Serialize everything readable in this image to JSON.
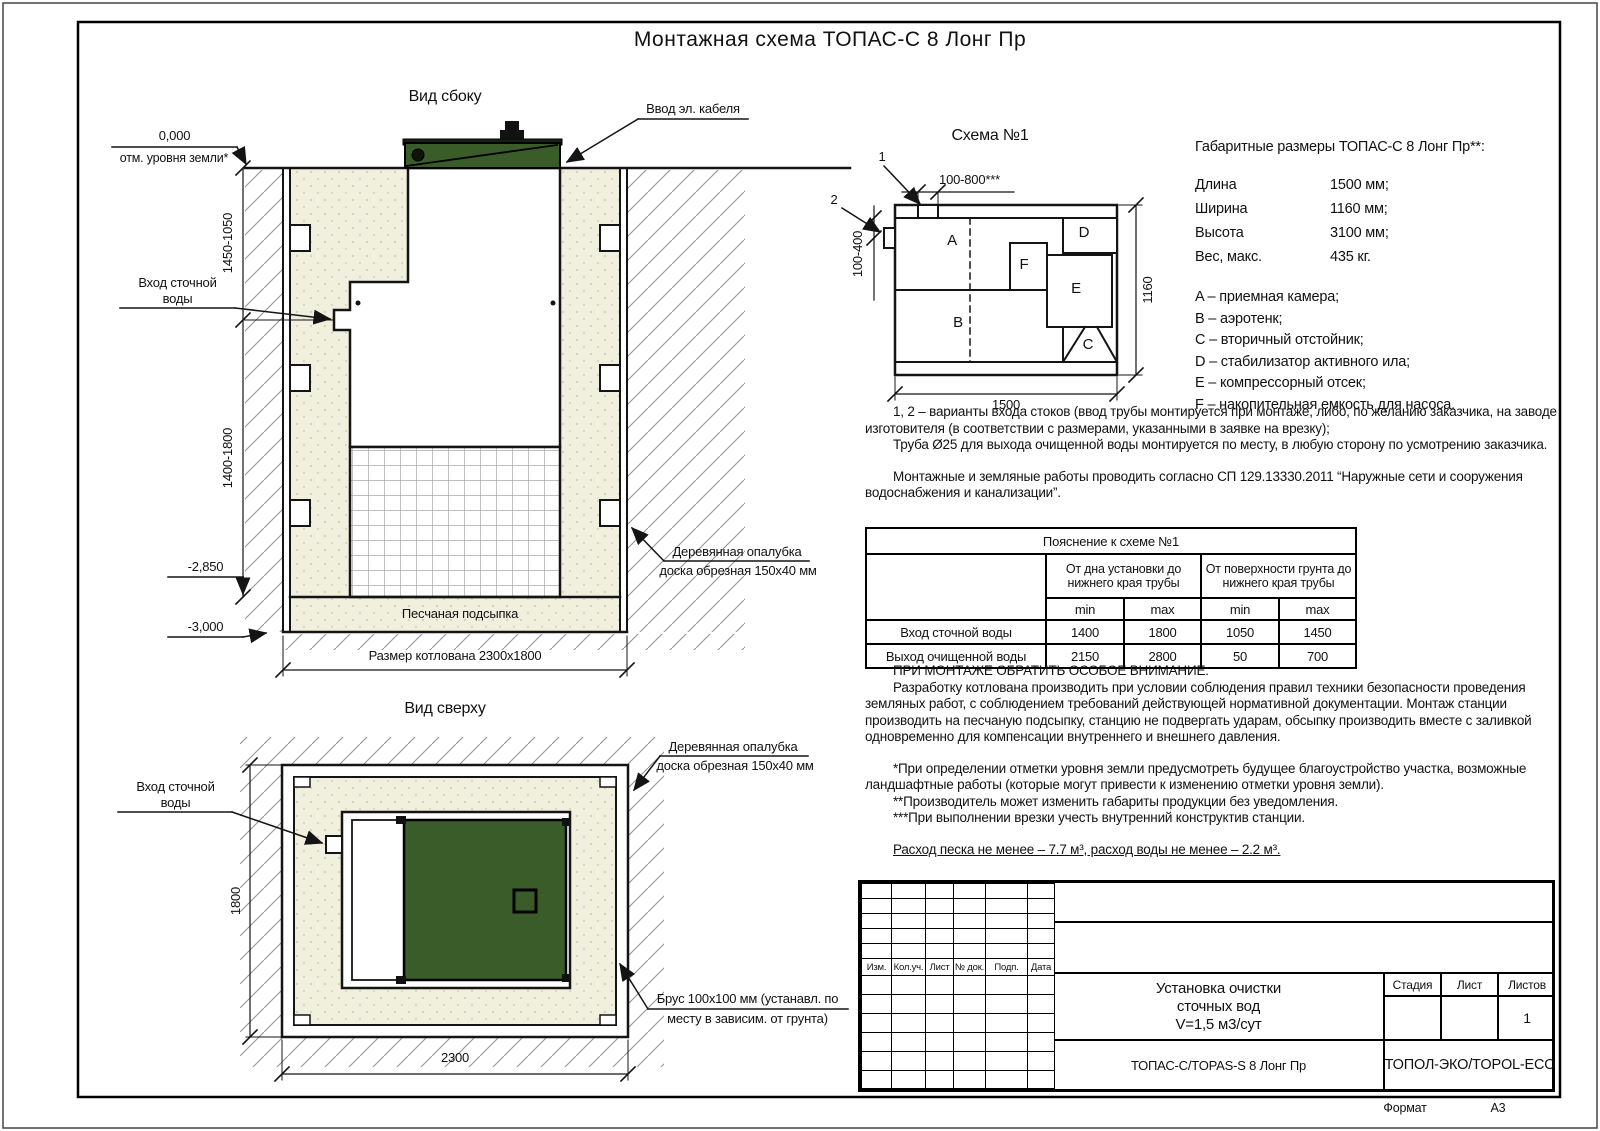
{
  "sheet": {
    "title": "Монтажная схема ТОПАС-С 8 Лонг Пр",
    "format_label": "Формат",
    "format_value": "А3"
  },
  "colors": {
    "lid_green": "#3a5c28",
    "sand": "#f1f0df",
    "line": "#141414"
  },
  "side_view": {
    "title": "Вид сбоку",
    "ground_level": "0,000",
    "ground_level_note": "отм. уровня земли*",
    "cable_entry": "Ввод эл. кабеля",
    "inlet_line1": "Вход сточной",
    "inlet_line2": "воды",
    "formwork_line1": "Деревянная опалубка",
    "formwork_line2": "доска обрезная 150х40 мм",
    "sand_bed": "Песчаная подсыпка",
    "pit_size": "Размер котлована 2300х1800",
    "dim_top": "1450-1050",
    "dim_bottom": "1400-1800",
    "level_sand": "-2,850",
    "level_bottom": "-3,000"
  },
  "top_view": {
    "title": "Вид сверху",
    "inlet_line1": "Вход сточной",
    "inlet_line2": "воды",
    "formwork_line1": "Деревянная опалубка",
    "formwork_line2": "доска обрезная 150х40 мм",
    "beam_line1": "Брус 100х100 мм (устанавл. по",
    "beam_line2": "месту в зависим. от грунта)",
    "dim_width": "1800",
    "dim_length": "2300"
  },
  "schema1": {
    "title": "Схема №1",
    "entry1": "1",
    "entry2": "2",
    "dim_top": "100-800***",
    "dim_left": "100-400",
    "dim_length": "1500",
    "dim_height": "1160",
    "zones": [
      "A",
      "B",
      "C",
      "D",
      "E",
      "F"
    ]
  },
  "specs": {
    "title": "Габаритные размеры ТОПАС-С 8 Лонг Пр**:",
    "rows": [
      {
        "label": "Длина",
        "value": "1500 мм;"
      },
      {
        "label": "Ширина",
        "value": "1160 мм;"
      },
      {
        "label": "Высота",
        "value": "3100 мм;"
      },
      {
        "label": "Вес, макс.",
        "value": "435 кг."
      }
    ],
    "legend": [
      "A – приемная камера;",
      "B – аэротенк;",
      "C – вторичный отстойник;",
      "D – стабилизатор активного ила;",
      "E – компрессорный отсек;",
      "F – накопительная емкость для насоса."
    ]
  },
  "notes": {
    "para1": "1, 2 – варианты входа  стоков (ввод трубы монтируется при монтаже, либо, по желанию заказчика, на заводе изготовителя (в соответствии с размерами, указанными в заявке на врезку);",
    "para2": "Труба Ø25 для выхода очищенной воды монтируется по месту, в любую сторону по усмотрению заказчика.",
    "para3": "Монтажные и земляные работы проводить согласно СП 129.13330.2011 “Наружные сети и сооружения водоснабжения и канализации”."
  },
  "table": {
    "caption": "Пояснение к схеме №1",
    "col1": "От дна установки до нижнего края трубы",
    "col2": "От поверхности грунта до нижнего края трубы",
    "min_label": "min",
    "max_label": "max",
    "rows": [
      {
        "name": "Вход сточной воды",
        "v1": "1400",
        "v2": "1800",
        "v3": "1050",
        "v4": "1450"
      },
      {
        "name": "Выход очищенной воды",
        "v1": "2150",
        "v2": "2800",
        "v3": "50",
        "v4": "700"
      }
    ]
  },
  "attention": {
    "heading": "ПРИ МОНТАЖЕ ОБРАТИТЬ ОСОБОЕ ВНИМАНИЕ:",
    "body": "Разработку котлована производить при условии соблюдения правил техники безопасности проведения земляных работ, с соблюдением требований действующей нормативной документации. Монтаж станции производить на песчаную подсыпку, станцию не подвергать ударам, обсыпку производить вместе с заливкой одновременно для компенсации внутреннего и внешнего давления.",
    "note1": "*При определении отметки уровня земли предусмотреть будущее благоустройство участка, возможные ландшафтные работы (которые могут привести к изменению отметки уровня земли).",
    "note2": "**Производитель может изменить габариты продукции без уведомления.",
    "note3": "***При выполнении врезки учесть внутренний конструктив станции.",
    "consumption": "Расход песка не менее – 7.7 м³, расход воды не менее – 2.2 м³."
  },
  "title_block": {
    "cols": [
      "Изм.",
      "Кол.уч.",
      "Лист",
      "№ док.",
      "Подп.",
      "Дата"
    ],
    "doc_title_line1": "Установка очистки",
    "doc_title_line2": "сточных вод",
    "doc_title_line3": "V=1,5 м3/сут",
    "stage_label": "Стадия",
    "sheet_label": "Лист",
    "sheets_label": "Листов",
    "sheets_value": "1",
    "product": "ТОПАС-С/TOPAS-S 8 Лонг Пр",
    "company": "ТОПОЛ-ЭКО/TOPOL-ECO"
  }
}
